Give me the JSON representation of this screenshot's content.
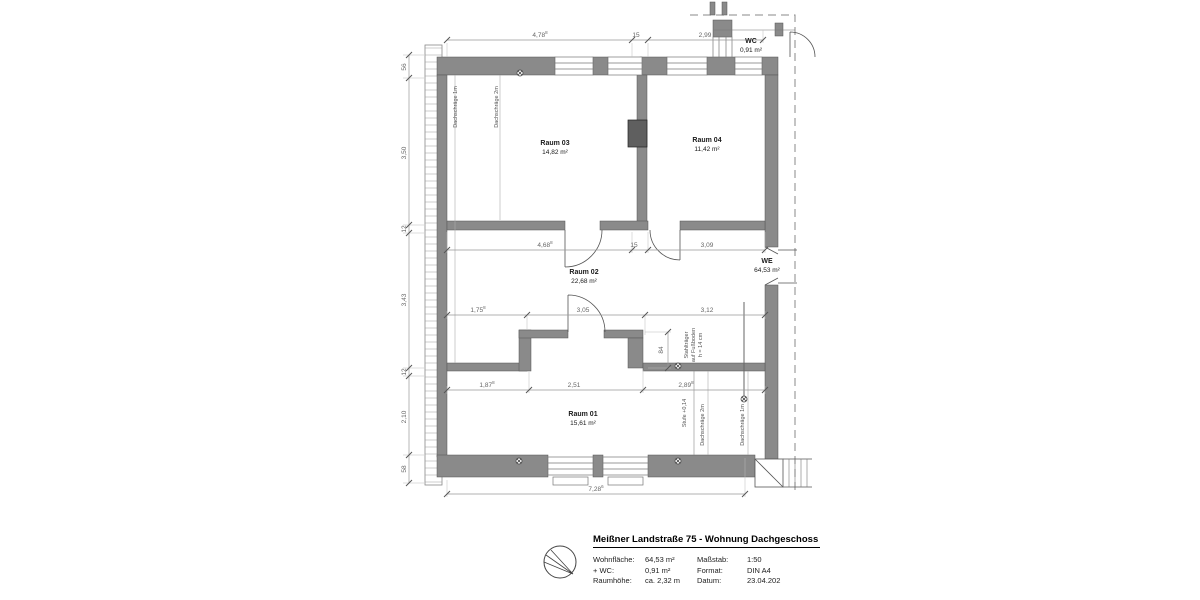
{
  "plan": {
    "rooms": {
      "raum03": {
        "name": "Raum 03",
        "area": "14,82 m²"
      },
      "raum04": {
        "name": "Raum 04",
        "area": "11,42 m²"
      },
      "raum02": {
        "name": "Raum 02",
        "area": "22,68 m²"
      },
      "raum01": {
        "name": "Raum 01",
        "area": "15,61 m²"
      },
      "wc": {
        "name": "WC",
        "area": "0,91 m²"
      },
      "we": {
        "name": "WE",
        "area": "64,53 m²"
      }
    },
    "dims": {
      "top1": {
        "v": "4,78",
        "s": "8"
      },
      "top2": {
        "v": "15",
        "s": ""
      },
      "top3": {
        "v": "2,99",
        "s": ""
      },
      "mid1": {
        "v": "4,68",
        "s": "8"
      },
      "mid2": {
        "v": "15",
        "s": ""
      },
      "mid3": {
        "v": "3,09",
        "s": ""
      },
      "r3a": {
        "v": "1,75",
        "s": "8"
      },
      "r3b": {
        "v": "3,05",
        "s": ""
      },
      "r3c": {
        "v": "3,12",
        "s": ""
      },
      "r4a": {
        "v": "1,87",
        "s": "8"
      },
      "r4b": {
        "v": "2,51",
        "s": ""
      },
      "r4c": {
        "v": "2,89",
        "s": "8"
      },
      "bottom": {
        "v": "7,28",
        "s": "6"
      },
      "left1": "56",
      "left2": "3,50",
      "left3": "12",
      "left4": "3,43",
      "left5": "12",
      "left6": "2,10",
      "left7": "58",
      "beam": "84"
    },
    "notes": {
      "dach1m_tl": "Dachschräge 1m",
      "dach2m_tl": "Dachschräge 2m",
      "stahl1": "Stahlträger",
      "stahl2": "auf Fußboden",
      "stahl3": "h = 14 cm",
      "stufe": "Stufe +0,14",
      "dach2m_br": "Dachschräge 2m",
      "dach1m_br": "Dachschräge 1m"
    }
  },
  "title_block": {
    "title": "Meißner Landstraße 75 - Wohnung Dachgeschoss",
    "fields_left": [
      {
        "label": "Wohnfläche:",
        "value": "64,53 m²"
      },
      {
        "label": "+ WC:",
        "value": "0,91 m²"
      },
      {
        "label": "Raumhöhe:",
        "value": "ca. 2,32 m"
      }
    ],
    "fields_right": [
      {
        "label": "Maßstab:",
        "value": "1:50"
      },
      {
        "label": "Format:",
        "value": "DIN A4"
      },
      {
        "label": "Datum:",
        "value": "23.04.202"
      }
    ]
  },
  "colors": {
    "wall": "#8a8a8a",
    "wall_dark": "#5f5f5f",
    "line": "#555555",
    "dim": "#999999",
    "dim_text": "#666666"
  }
}
